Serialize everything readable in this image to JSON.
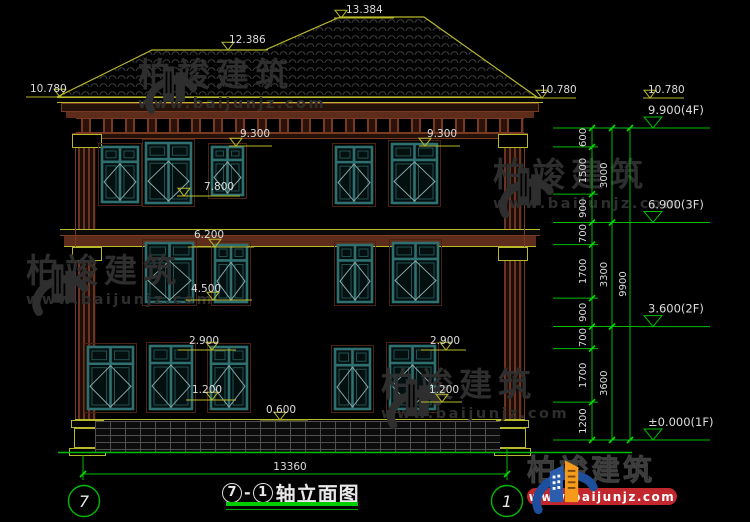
{
  "title": {
    "axis_start": "7",
    "axis_end": "1",
    "dash": "-",
    "name": "轴立面图"
  },
  "axis_bubbles": [
    {
      "label": "7"
    },
    {
      "label": "1"
    }
  ],
  "watermark": {
    "brand": "柏竣建筑",
    "url": "www.baijunjz.com"
  },
  "brand_logo": {
    "brand": "柏竣建筑",
    "url": "www.baijunjz.com"
  },
  "colors": {
    "background": "#000000",
    "cad_yellow": "#b9b92e",
    "cad_green": "#00bb00",
    "tick_green": "#00dd00",
    "window_teal": "#2f6f6f",
    "cornice_brown": "#5e2c1a",
    "text_white": "#dcdcdc",
    "watermark_gray": "#2e2e2e",
    "logo_blue": "#1d4f9c",
    "logo_orange": "#f59a1a",
    "logo_red": "#c1272d"
  },
  "drawing": {
    "elevation_flags": [
      {
        "label": "13.384",
        "tx": 346,
        "ty": 13,
        "x1": 334,
        "x2": 394,
        "ly": 18,
        "ax": 341
      },
      {
        "label": "12.386",
        "tx": 229,
        "ty": 43,
        "x1": 221,
        "x2": 268,
        "ly": 50,
        "ax": 228
      },
      {
        "label": "10.780",
        "tx": 30,
        "ty": 92,
        "x1": 26,
        "x2": 68,
        "ly": 97,
        "ax": 60
      },
      {
        "label": "10.780",
        "tx": 540,
        "ty": 93,
        "x1": 535,
        "x2": 576,
        "ly": 98,
        "ax": 542
      },
      {
        "label": "10.780",
        "tx": 648,
        "ty": 93,
        "x1": 643,
        "x2": 684,
        "ly": 98,
        "ax": 650
      },
      {
        "label": "9.300",
        "tx": 240,
        "ty": 137,
        "x1": 229,
        "x2": 272,
        "ly": 146,
        "ax": 236
      },
      {
        "label": "9.300",
        "tx": 427,
        "ty": 137,
        "x1": 419,
        "x2": 460,
        "ly": 146,
        "ax": 425
      },
      {
        "label": "7.800",
        "tx": 204,
        "ty": 190,
        "x1": 177,
        "x2": 240,
        "ly": 196,
        "ax": 184
      },
      {
        "label": "6.200",
        "tx": 194,
        "ty": 238,
        "x1": 188,
        "x2": 254,
        "ly": 247,
        "ax": 215
      },
      {
        "label": "4.500",
        "tx": 191,
        "ty": 292,
        "x1": 186,
        "x2": 252,
        "ly": 300,
        "ax": 213
      },
      {
        "label": "2.900",
        "tx": 189,
        "ty": 344,
        "x1": 178,
        "x2": 236,
        "ly": 350,
        "ax": 212
      },
      {
        "label": "2.900",
        "tx": 430,
        "ty": 344,
        "x1": 421,
        "x2": 466,
        "ly": 350,
        "ax": 446
      },
      {
        "label": "1.200",
        "tx": 192,
        "ty": 393,
        "x1": 186,
        "x2": 236,
        "ly": 400,
        "ax": 212
      },
      {
        "label": "1.200",
        "tx": 429,
        "ty": 393,
        "x1": 421,
        "x2": 462,
        "ly": 402,
        "ax": 442
      },
      {
        "label": "0.600",
        "tx": 266,
        "ty": 413,
        "x1": 260,
        "x2": 308,
        "ly": 420,
        "ax": 280
      }
    ],
    "floor_markers": [
      {
        "label": "9.900(4F)",
        "y": 128
      },
      {
        "label": "6.900(3F)",
        "y": 222.5
      },
      {
        "label": "3.600(2F)",
        "y": 326.6
      },
      {
        "label": "±0.000(1F)",
        "y": 440
      }
    ],
    "chain_segments_mm": [
      600,
      1500,
      900,
      700,
      1700,
      900,
      700,
      1700,
      1200
    ],
    "chain_groups_mm": [
      3000,
      3300,
      3600
    ],
    "chain_total_mm": 9900,
    "bottom_dimension": {
      "label": "13360"
    },
    "windows": [
      [
        102,
        147,
        36,
        55
      ],
      [
        146,
        143,
        45,
        60
      ],
      [
        212,
        147,
        31,
        48
      ],
      [
        336,
        147,
        36,
        56
      ],
      [
        392,
        144,
        45,
        59
      ],
      [
        146,
        243,
        47,
        59
      ],
      [
        215,
        245,
        32,
        57
      ],
      [
        338,
        245,
        34,
        57
      ],
      [
        393,
        243,
        45,
        59
      ],
      [
        88,
        347,
        45,
        62
      ],
      [
        150,
        346,
        42,
        63
      ],
      [
        211,
        347,
        36,
        62
      ],
      [
        335,
        349,
        35,
        60
      ],
      [
        390,
        346,
        45,
        63
      ]
    ],
    "roof_outline": "57,97 152,50 265,50 340,17 424,17 537,97"
  }
}
